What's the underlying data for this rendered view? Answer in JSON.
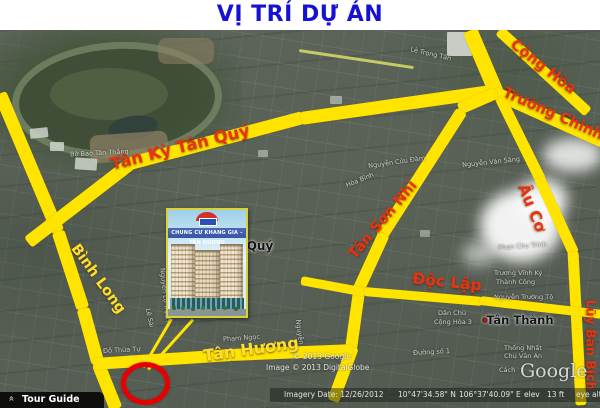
{
  "title": "VỊ TRÍ DỰ ÁN",
  "inset": {
    "banner": "CHUNG CƯ KHANG GIA – TÂN HƯƠNG"
  },
  "roads": {
    "binh_long": "Bình Long",
    "tan_ky_tan_quy": "Tân Kỳ Tân Quý",
    "cong_hoa": "Cộng Hòa",
    "truong_chinh": "Trường Chinh",
    "au_co": "Âu Cơ",
    "tan_son_nhi": "Tân Sơn Nhì",
    "doc_lap": "Độc Lập",
    "tan_huong": "Tân Hương",
    "luy_ban_bich": "Lũy Bán Bích"
  },
  "places": {
    "quy": "Quý",
    "tan_thanh": "Tân Thành"
  },
  "streets": {
    "bo_bao_tan_thang": "Bờ Bao Tân Thắng",
    "le_trong_tan": "Lê Trọng Tấn",
    "nguyen_cuu_dam": "Nguyễn Cửu Đàm",
    "nguyen_van_sang": "Nguyễn Văn Săng",
    "hoa_binh": "Hòa Bình",
    "phan_chu_trinh": "Phan Chu Trinh",
    "truong_vinh_ky": "Trương Vĩnh Ký",
    "thanh_cong": "Thành Công",
    "nguyen_truong_to": "Nguyễn Trường Tộ",
    "dan_chu": "Dân Chủ",
    "cong_hoa_3": "Cộng Hòa 3",
    "thong_nhat": "Thống Nhất",
    "chu_van_an": "Chu Văn An",
    "duong_so_1": "Đường số 1",
    "pham_ngoc": "Phạm Ngọc",
    "do_thua_tu": "Đỗ Thừa Tự",
    "le_sai": "Lê Sài",
    "nguyen_lo_trach": "Nguyễn Lộ Trạch",
    "nguyen": "Nguyễn",
    "cach": "Cách"
  },
  "watermarks": {
    "copyright_google": "© 2013 Google",
    "copyright_digitalglobe": "Image © 2013 DigitalGlobe",
    "google_logo": "Google"
  },
  "status_bar": {
    "imagery_date": "Imagery Date: 12/26/2012",
    "latitude": "10°47'34.58\" N",
    "longitude": "106°37'40.09\" E",
    "elev_label": "elev",
    "elevation": "13 ft",
    "eye_alt_label": "eye alt"
  },
  "toolbar": {
    "tour_guide": "Tour Guide"
  },
  "colors": {
    "road_yellow": "#ffe400",
    "road_label_red": "#e8330e",
    "road_label_yellow": "#ffdf2e",
    "title_blue": "#1712d2",
    "marker_red": "#e80000"
  }
}
